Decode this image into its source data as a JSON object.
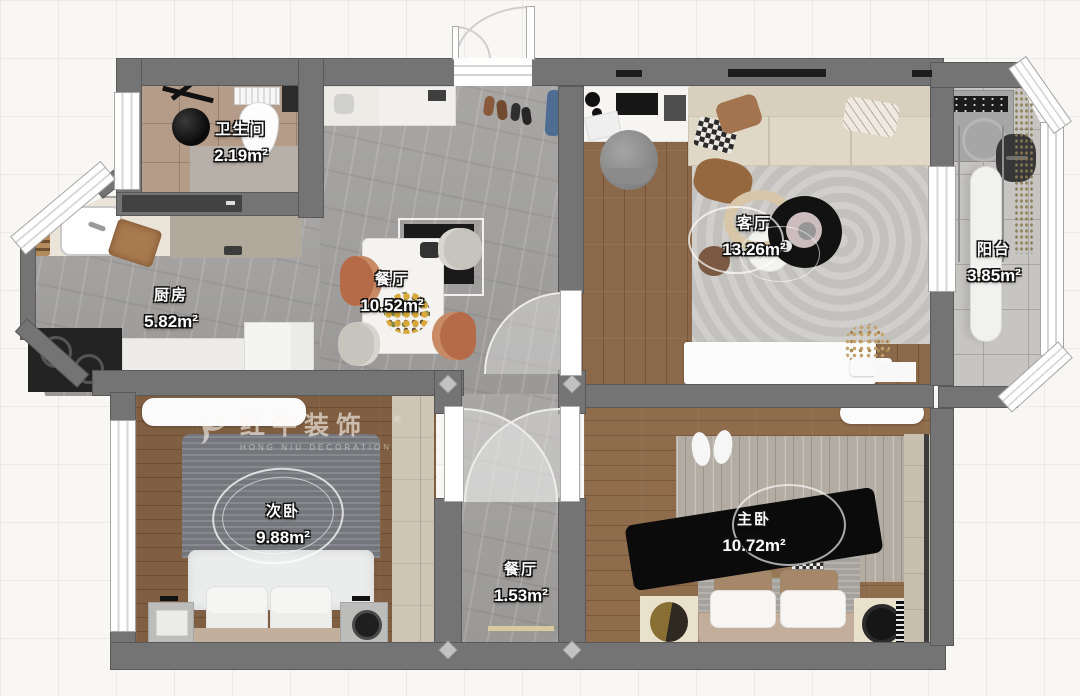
{
  "watermark": {
    "brand": "红牛装饰",
    "sub": "HONG NIU DECORATION",
    "reg": "®"
  },
  "rooms": {
    "bathroom": {
      "label": "卫生间",
      "area": "2.19m²"
    },
    "kitchen": {
      "label": "厨房",
      "area": "5.82m²"
    },
    "dining": {
      "label": "餐厅",
      "area": "10.52m²"
    },
    "living": {
      "label": "客厅",
      "area": "13.26m²"
    },
    "balcony": {
      "label": "阳台",
      "area": "3.85m²"
    },
    "bedroom2": {
      "label": "次卧",
      "area": "9.88m²"
    },
    "master": {
      "label": "主卧",
      "area": "10.72m²"
    },
    "hallway": {
      "label": "餐厅",
      "area": "1.53m²"
    }
  },
  "colors": {
    "wall": "#757474",
    "wood_floor": "#8a6849",
    "marble_floor": "#a3a2a0",
    "bath_tile": "#b59c89",
    "balcony_tile": "#c6c5c1",
    "chair_accent": "#b66b48",
    "label_text": "#ffffff"
  }
}
